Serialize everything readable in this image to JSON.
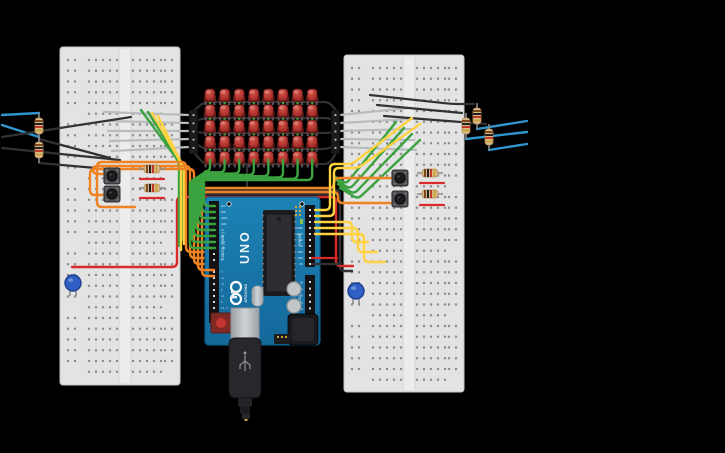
{
  "app": {
    "background": "#000000",
    "width": 725,
    "height": 453
  },
  "arduino": {
    "x": 205,
    "y": 197,
    "w": 115,
    "h": 148,
    "board_color": "#1878a8",
    "labels": {
      "uno": "UNO",
      "brand": "ARDUINO",
      "digital": "DIGITAL (PWM~)",
      "power": "POWER",
      "analog": "ANALOG IN"
    },
    "digital_pins": [
      "SCL",
      "SDA",
      "AREF",
      "GND",
      "13",
      "12",
      "~11",
      "~10",
      "~9",
      "8",
      "7",
      "~6",
      "~5",
      "4",
      "~3",
      "2",
      "TX→1",
      "RX←0"
    ],
    "power_pins": [
      "IOREF",
      "RESET",
      "3.3V",
      "5V",
      "GND",
      "GND",
      "VIN"
    ],
    "analog_pins": [
      "A0",
      "A1",
      "A2",
      "A3",
      "A4",
      "A5"
    ]
  },
  "breadboards": [
    {
      "id": "left",
      "x": 60,
      "y": 47,
      "w": 120,
      "h": 338
    },
    {
      "id": "right",
      "x": 344,
      "y": 55,
      "w": 120,
      "h": 337
    }
  ],
  "led_matrix": {
    "rows": 5,
    "cols": 8,
    "origin_x": 210,
    "origin_y": 97,
    "dx": 14.6,
    "dy": 15.6,
    "led_color": "#b23530",
    "headers": [
      {
        "x": 189,
        "y": 110
      },
      {
        "x": 331,
        "y": 110
      }
    ]
  },
  "pushbuttons": [
    {
      "x": 112,
      "y": 176
    },
    {
      "x": 112,
      "y": 194
    },
    {
      "x": 400,
      "y": 178
    },
    {
      "x": 400,
      "y": 199
    }
  ],
  "resistors_vertical": [
    {
      "x": 39,
      "cy": 126
    },
    {
      "x": 39,
      "cy": 150
    },
    {
      "x": 477,
      "cy": 116
    },
    {
      "x": 466,
      "cy": 126
    },
    {
      "x": 489,
      "cy": 137
    }
  ],
  "resistors_horizontal": [
    {
      "cx": 152,
      "y": 169
    },
    {
      "cx": 152,
      "y": 188
    },
    {
      "cx": 430,
      "y": 173
    },
    {
      "cx": 430,
      "y": 194
    }
  ],
  "indicator_leds": [
    {
      "x": 73,
      "cy": 283,
      "color": "#2e5fc5"
    },
    {
      "x": 356,
      "cy": 291,
      "color": "#2e5fc5"
    }
  ],
  "usb_cable": {
    "x": 229,
    "y": 338
  },
  "palette": {
    "green": "#3aa33f",
    "orange": "#ef8222",
    "yellow": "#ffd23f",
    "red": "#d92b2b",
    "black": "#323236",
    "gray": "#b9bcbf",
    "blue": "#3095cc"
  },
  "wires_under": [
    {
      "c": "#323236",
      "w": 2.2,
      "p": [
        [
          189,
          115
        ],
        [
          204,
          102
        ],
        [
          329,
          102
        ],
        [
          340,
          115
        ]
      ]
    },
    {
      "c": "#323236",
      "w": 2.2,
      "p": [
        [
          189,
          123
        ],
        [
          204,
          118
        ],
        [
          329,
          118
        ],
        [
          340,
          123
        ]
      ]
    },
    {
      "c": "#323236",
      "w": 2.2,
      "p": [
        [
          189,
          131
        ],
        [
          204,
          133
        ],
        [
          329,
          133
        ],
        [
          340,
          131
        ]
      ]
    },
    {
      "c": "#323236",
      "w": 2.2,
      "p": [
        [
          189,
          139
        ],
        [
          204,
          149
        ],
        [
          329,
          149
        ],
        [
          340,
          139
        ]
      ]
    },
    {
      "c": "#323236",
      "w": 2.2,
      "p": [
        [
          189,
          147
        ],
        [
          204,
          164
        ],
        [
          329,
          164
        ],
        [
          340,
          147
        ]
      ]
    },
    {
      "c": "#3aa33f",
      "w": 2.2,
      "p": [
        [
          210,
          93
        ],
        [
          210,
          165
        ]
      ]
    },
    {
      "c": "#3aa33f",
      "w": 2.2,
      "p": [
        [
          224.6,
          93
        ],
        [
          224.6,
          165
        ]
      ]
    },
    {
      "c": "#3aa33f",
      "w": 2.2,
      "p": [
        [
          239.2,
          93
        ],
        [
          239.2,
          165
        ]
      ]
    },
    {
      "c": "#3aa33f",
      "w": 2.2,
      "p": [
        [
          253.8,
          93
        ],
        [
          253.8,
          165
        ]
      ]
    },
    {
      "c": "#3aa33f",
      "w": 2.2,
      "p": [
        [
          268.4,
          93
        ],
        [
          268.4,
          165
        ]
      ]
    },
    {
      "c": "#3aa33f",
      "w": 2.2,
      "p": [
        [
          283,
          93
        ],
        [
          283,
          165
        ]
      ]
    },
    {
      "c": "#3aa33f",
      "w": 2.2,
      "p": [
        [
          297.6,
          93
        ],
        [
          297.6,
          165
        ]
      ]
    },
    {
      "c": "#3aa33f",
      "w": 2.2,
      "p": [
        [
          312.2,
          93
        ],
        [
          312.2,
          165
        ]
      ]
    },
    {
      "c": "#323236",
      "w": 2.2,
      "p": [
        [
          247,
          164
        ],
        [
          247,
          191
        ]
      ]
    },
    {
      "c": "#323236",
      "w": 2.4,
      "p": [
        [
          196,
          190
        ],
        [
          340,
          190
        ],
        [
          340,
          271
        ],
        [
          352,
          271
        ]
      ]
    },
    {
      "c": "#323236",
      "w": 2.4,
      "p": [
        [
          196,
          194
        ],
        [
          334,
          194
        ]
      ]
    },
    {
      "c": "#d92b2b",
      "w": 2.4,
      "p": [
        [
          72,
          267
        ],
        [
          177,
          267
        ],
        [
          177,
          197
        ],
        [
          336,
          197
        ],
        [
          336,
          266
        ],
        [
          353,
          266
        ]
      ]
    },
    {
      "c": "#b9bcbf",
      "w": 2.2,
      "p": [
        [
          104,
          112
        ],
        [
          189,
          115
        ]
      ]
    },
    {
      "c": "#b9bcbf",
      "w": 2.2,
      "p": [
        [
          106,
          121
        ],
        [
          189,
          123
        ]
      ]
    },
    {
      "c": "#b9bcbf",
      "w": 2.2,
      "p": [
        [
          108,
          131
        ],
        [
          189,
          131
        ]
      ]
    },
    {
      "c": "#b9bcbf",
      "w": 2.2,
      "p": [
        [
          110,
          141
        ],
        [
          189,
          139
        ]
      ]
    },
    {
      "c": "#b9bcbf",
      "w": 2.2,
      "p": [
        [
          112,
          151
        ],
        [
          189,
          147
        ]
      ]
    },
    {
      "c": "#b9bcbf",
      "w": 2.2,
      "p": [
        [
          340,
          115
        ],
        [
          408,
          108
        ]
      ]
    },
    {
      "c": "#b9bcbf",
      "w": 2.2,
      "p": [
        [
          340,
          123
        ],
        [
          410,
          119
        ]
      ]
    },
    {
      "c": "#b9bcbf",
      "w": 2.2,
      "p": [
        [
          340,
          131
        ],
        [
          412,
          129
        ]
      ]
    },
    {
      "c": "#b9bcbf",
      "w": 2.2,
      "p": [
        [
          340,
          139
        ],
        [
          414,
          140
        ]
      ]
    },
    {
      "c": "#b9bcbf",
      "w": 2.2,
      "p": [
        [
          340,
          147
        ],
        [
          416,
          150
        ]
      ]
    },
    {
      "c": "#3095cc",
      "w": 2.4,
      "p": [
        [
          2,
          115
        ],
        [
          39,
          113
        ]
      ]
    },
    {
      "c": "#3095cc",
      "w": 2.4,
      "p": [
        [
          2,
          125
        ],
        [
          39,
          137
        ]
      ]
    },
    {
      "c": "#323236",
      "w": 2.2,
      "p": [
        [
          2,
          137
        ],
        [
          131,
          117
        ]
      ]
    },
    {
      "c": "#323236",
      "w": 2.2,
      "p": [
        [
          2,
          148
        ],
        [
          120,
          160
        ]
      ]
    },
    {
      "c": "#323236",
      "w": 2.2,
      "p": [
        [
          39,
          139
        ],
        [
          110,
          158
        ]
      ]
    },
    {
      "c": "#323236",
      "w": 2.2,
      "p": [
        [
          39,
          163
        ],
        [
          96,
          168
        ]
      ]
    },
    {
      "c": "#323236",
      "w": 2.2,
      "p": [
        [
          370,
          95
        ],
        [
          452,
          104
        ],
        [
          474,
          104
        ]
      ]
    },
    {
      "c": "#323236",
      "w": 2.2,
      "p": [
        [
          377,
          105
        ],
        [
          462,
          113
        ]
      ]
    },
    {
      "c": "#323236",
      "w": 2.2,
      "p": [
        [
          384,
          116
        ],
        [
          486,
          124
        ]
      ]
    },
    {
      "c": "#3095cc",
      "w": 2.4,
      "p": [
        [
          477,
          129
        ],
        [
          527,
          121
        ]
      ]
    },
    {
      "c": "#3095cc",
      "w": 2.4,
      "p": [
        [
          466,
          139
        ],
        [
          527,
          132
        ]
      ]
    },
    {
      "c": "#3095cc",
      "w": 2.4,
      "p": [
        [
          489,
          150
        ],
        [
          527,
          144
        ]
      ]
    },
    {
      "c": "#3aa33f",
      "w": 2.4,
      "p": [
        [
          141,
          110
        ],
        [
          179,
          162
        ],
        [
          179,
          246
        ]
      ]
    },
    {
      "c": "#3aa33f",
      "w": 2.4,
      "p": [
        [
          148,
          112
        ],
        [
          183,
          167
        ],
        [
          183,
          240
        ]
      ]
    },
    {
      "c": "#ffd23f",
      "w": 2.4,
      "p": [
        [
          152,
          113
        ],
        [
          181,
          163
        ],
        [
          181,
          250
        ]
      ]
    },
    {
      "c": "#ffd23f",
      "w": 2.4,
      "p": [
        [
          158,
          116
        ],
        [
          184,
          168
        ],
        [
          184,
          244
        ]
      ]
    },
    {
      "c": "#3aa33f",
      "w": 2.4,
      "p": [
        [
          334,
          176
        ],
        [
          346,
          184
        ],
        [
          396,
          122
        ]
      ]
    },
    {
      "c": "#3aa33f",
      "w": 2.4,
      "p": [
        [
          336,
          180
        ],
        [
          350,
          189
        ],
        [
          404,
          128
        ]
      ]
    },
    {
      "c": "#3aa33f",
      "w": 2.4,
      "p": [
        [
          338,
          184
        ],
        [
          354,
          194
        ],
        [
          412,
          134
        ]
      ]
    },
    {
      "c": "#3aa33f",
      "w": 2.4,
      "p": [
        [
          340,
          188
        ],
        [
          358,
          199
        ],
        [
          420,
          140
        ]
      ]
    },
    {
      "c": "#d92b2b",
      "w": 2.2,
      "p": [
        [
          140,
          179
        ],
        [
          164,
          179
        ]
      ]
    },
    {
      "c": "#d92b2b",
      "w": 2.2,
      "p": [
        [
          140,
          198
        ],
        [
          164,
          198
        ]
      ]
    },
    {
      "c": "#d92b2b",
      "w": 2.2,
      "p": [
        [
          420,
          183
        ],
        [
          444,
          183
        ]
      ]
    },
    {
      "c": "#d92b2b",
      "w": 2.2,
      "p": [
        [
          420,
          205
        ],
        [
          444,
          205
        ]
      ]
    },
    {
      "c": "#ef8222",
      "w": 2.4,
      "p": [
        [
          135,
          207
        ],
        [
          97,
          207
        ],
        [
          97,
          162
        ],
        [
          186,
          162
        ],
        [
          186,
          252
        ],
        [
          214,
          252
        ]
      ]
    },
    {
      "c": "#ef8222",
      "w": 2.4,
      "p": [
        [
          104,
          174
        ],
        [
          93,
          174
        ],
        [
          93,
          166
        ],
        [
          190,
          166
        ],
        [
          190,
          258
        ],
        [
          214,
          258
        ]
      ]
    },
    {
      "c": "#ef8222",
      "w": 2.4,
      "p": [
        [
          104,
          195
        ],
        [
          90,
          195
        ],
        [
          90,
          169
        ],
        [
          194,
          169
        ],
        [
          194,
          264
        ],
        [
          214,
          264
        ]
      ]
    }
  ],
  "wires_over": [
    {
      "c": "#ef8222",
      "w": 2.4,
      "p": [
        [
          214,
          270
        ],
        [
          198,
          270
        ],
        [
          198,
          188
        ],
        [
          334,
          188
        ],
        [
          334,
          178
        ],
        [
          392,
          178
        ]
      ]
    },
    {
      "c": "#ef8222",
      "w": 2.4,
      "p": [
        [
          214,
          276
        ],
        [
          202,
          276
        ],
        [
          202,
          192
        ],
        [
          338,
          192
        ],
        [
          338,
          203
        ],
        [
          392,
          203
        ]
      ]
    },
    {
      "c": "#3aa33f",
      "w": 2.4,
      "p": [
        [
          215,
          206
        ],
        [
          204,
          206
        ],
        [
          204,
          171
        ],
        [
          210,
          171
        ],
        [
          210,
          160
        ]
      ]
    },
    {
      "c": "#3aa33f",
      "w": 2.4,
      "p": [
        [
          215,
          212
        ],
        [
          202,
          212
        ],
        [
          202,
          172.3
        ],
        [
          224.6,
          172.3
        ],
        [
          224.6,
          160
        ]
      ]
    },
    {
      "c": "#3aa33f",
      "w": 2.4,
      "p": [
        [
          215,
          218
        ],
        [
          200,
          218
        ],
        [
          200,
          173.6
        ],
        [
          239.2,
          173.6
        ],
        [
          239.2,
          160
        ]
      ]
    },
    {
      "c": "#3aa33f",
      "w": 2.4,
      "p": [
        [
          215,
          224
        ],
        [
          198,
          224
        ],
        [
          198,
          174.9
        ],
        [
          253.8,
          174.9
        ],
        [
          253.8,
          160
        ]
      ]
    },
    {
      "c": "#3aa33f",
      "w": 2.4,
      "p": [
        [
          215,
          230
        ],
        [
          196,
          230
        ],
        [
          196,
          176.2
        ],
        [
          268.4,
          176.2
        ],
        [
          268.4,
          160
        ]
      ]
    },
    {
      "c": "#3aa33f",
      "w": 2.4,
      "p": [
        [
          215,
          236
        ],
        [
          194,
          236
        ],
        [
          194,
          177.5
        ],
        [
          283,
          177.5
        ],
        [
          283,
          160
        ]
      ]
    },
    {
      "c": "#3aa33f",
      "w": 2.4,
      "p": [
        [
          215,
          242
        ],
        [
          192,
          242
        ],
        [
          192,
          178.8
        ],
        [
          297.6,
          178.8
        ],
        [
          297.6,
          160
        ]
      ]
    },
    {
      "c": "#3aa33f",
      "w": 2.4,
      "p": [
        [
          215,
          248
        ],
        [
          190,
          248
        ],
        [
          190,
          180
        ],
        [
          312.2,
          180
        ],
        [
          312.2,
          160
        ]
      ]
    },
    {
      "c": "#ffd23f",
      "w": 2.4,
      "p": [
        [
          315,
          210
        ],
        [
          330,
          210
        ],
        [
          330,
          164
        ],
        [
          352,
          164
        ],
        [
          412,
          118
        ]
      ]
    },
    {
      "c": "#ffd23f",
      "w": 2.4,
      "p": [
        [
          315,
          216
        ],
        [
          334,
          216
        ],
        [
          334,
          168
        ],
        [
          358,
          168
        ],
        [
          420,
          124
        ]
      ]
    },
    {
      "c": "#ffd23f",
      "w": 2.4,
      "p": [
        [
          315,
          222
        ],
        [
          352,
          222
        ],
        [
          352,
          242
        ],
        [
          368,
          242
        ]
      ]
    },
    {
      "c": "#ffd23f",
      "w": 2.4,
      "p": [
        [
          315,
          228
        ],
        [
          358,
          228
        ],
        [
          358,
          252
        ],
        [
          377,
          252
        ]
      ]
    },
    {
      "c": "#ffd23f",
      "w": 2.4,
      "p": [
        [
          315,
          234
        ],
        [
          364,
          234
        ],
        [
          364,
          262
        ],
        [
          385,
          262
        ]
      ]
    },
    {
      "c": "#d92b2b",
      "w": 2.2,
      "p": [
        [
          312,
          258
        ],
        [
          337,
          258
        ]
      ]
    },
    {
      "c": "#323236",
      "w": 2.2,
      "p": [
        [
          312,
          264
        ],
        [
          341,
          264
        ]
      ]
    }
  ]
}
